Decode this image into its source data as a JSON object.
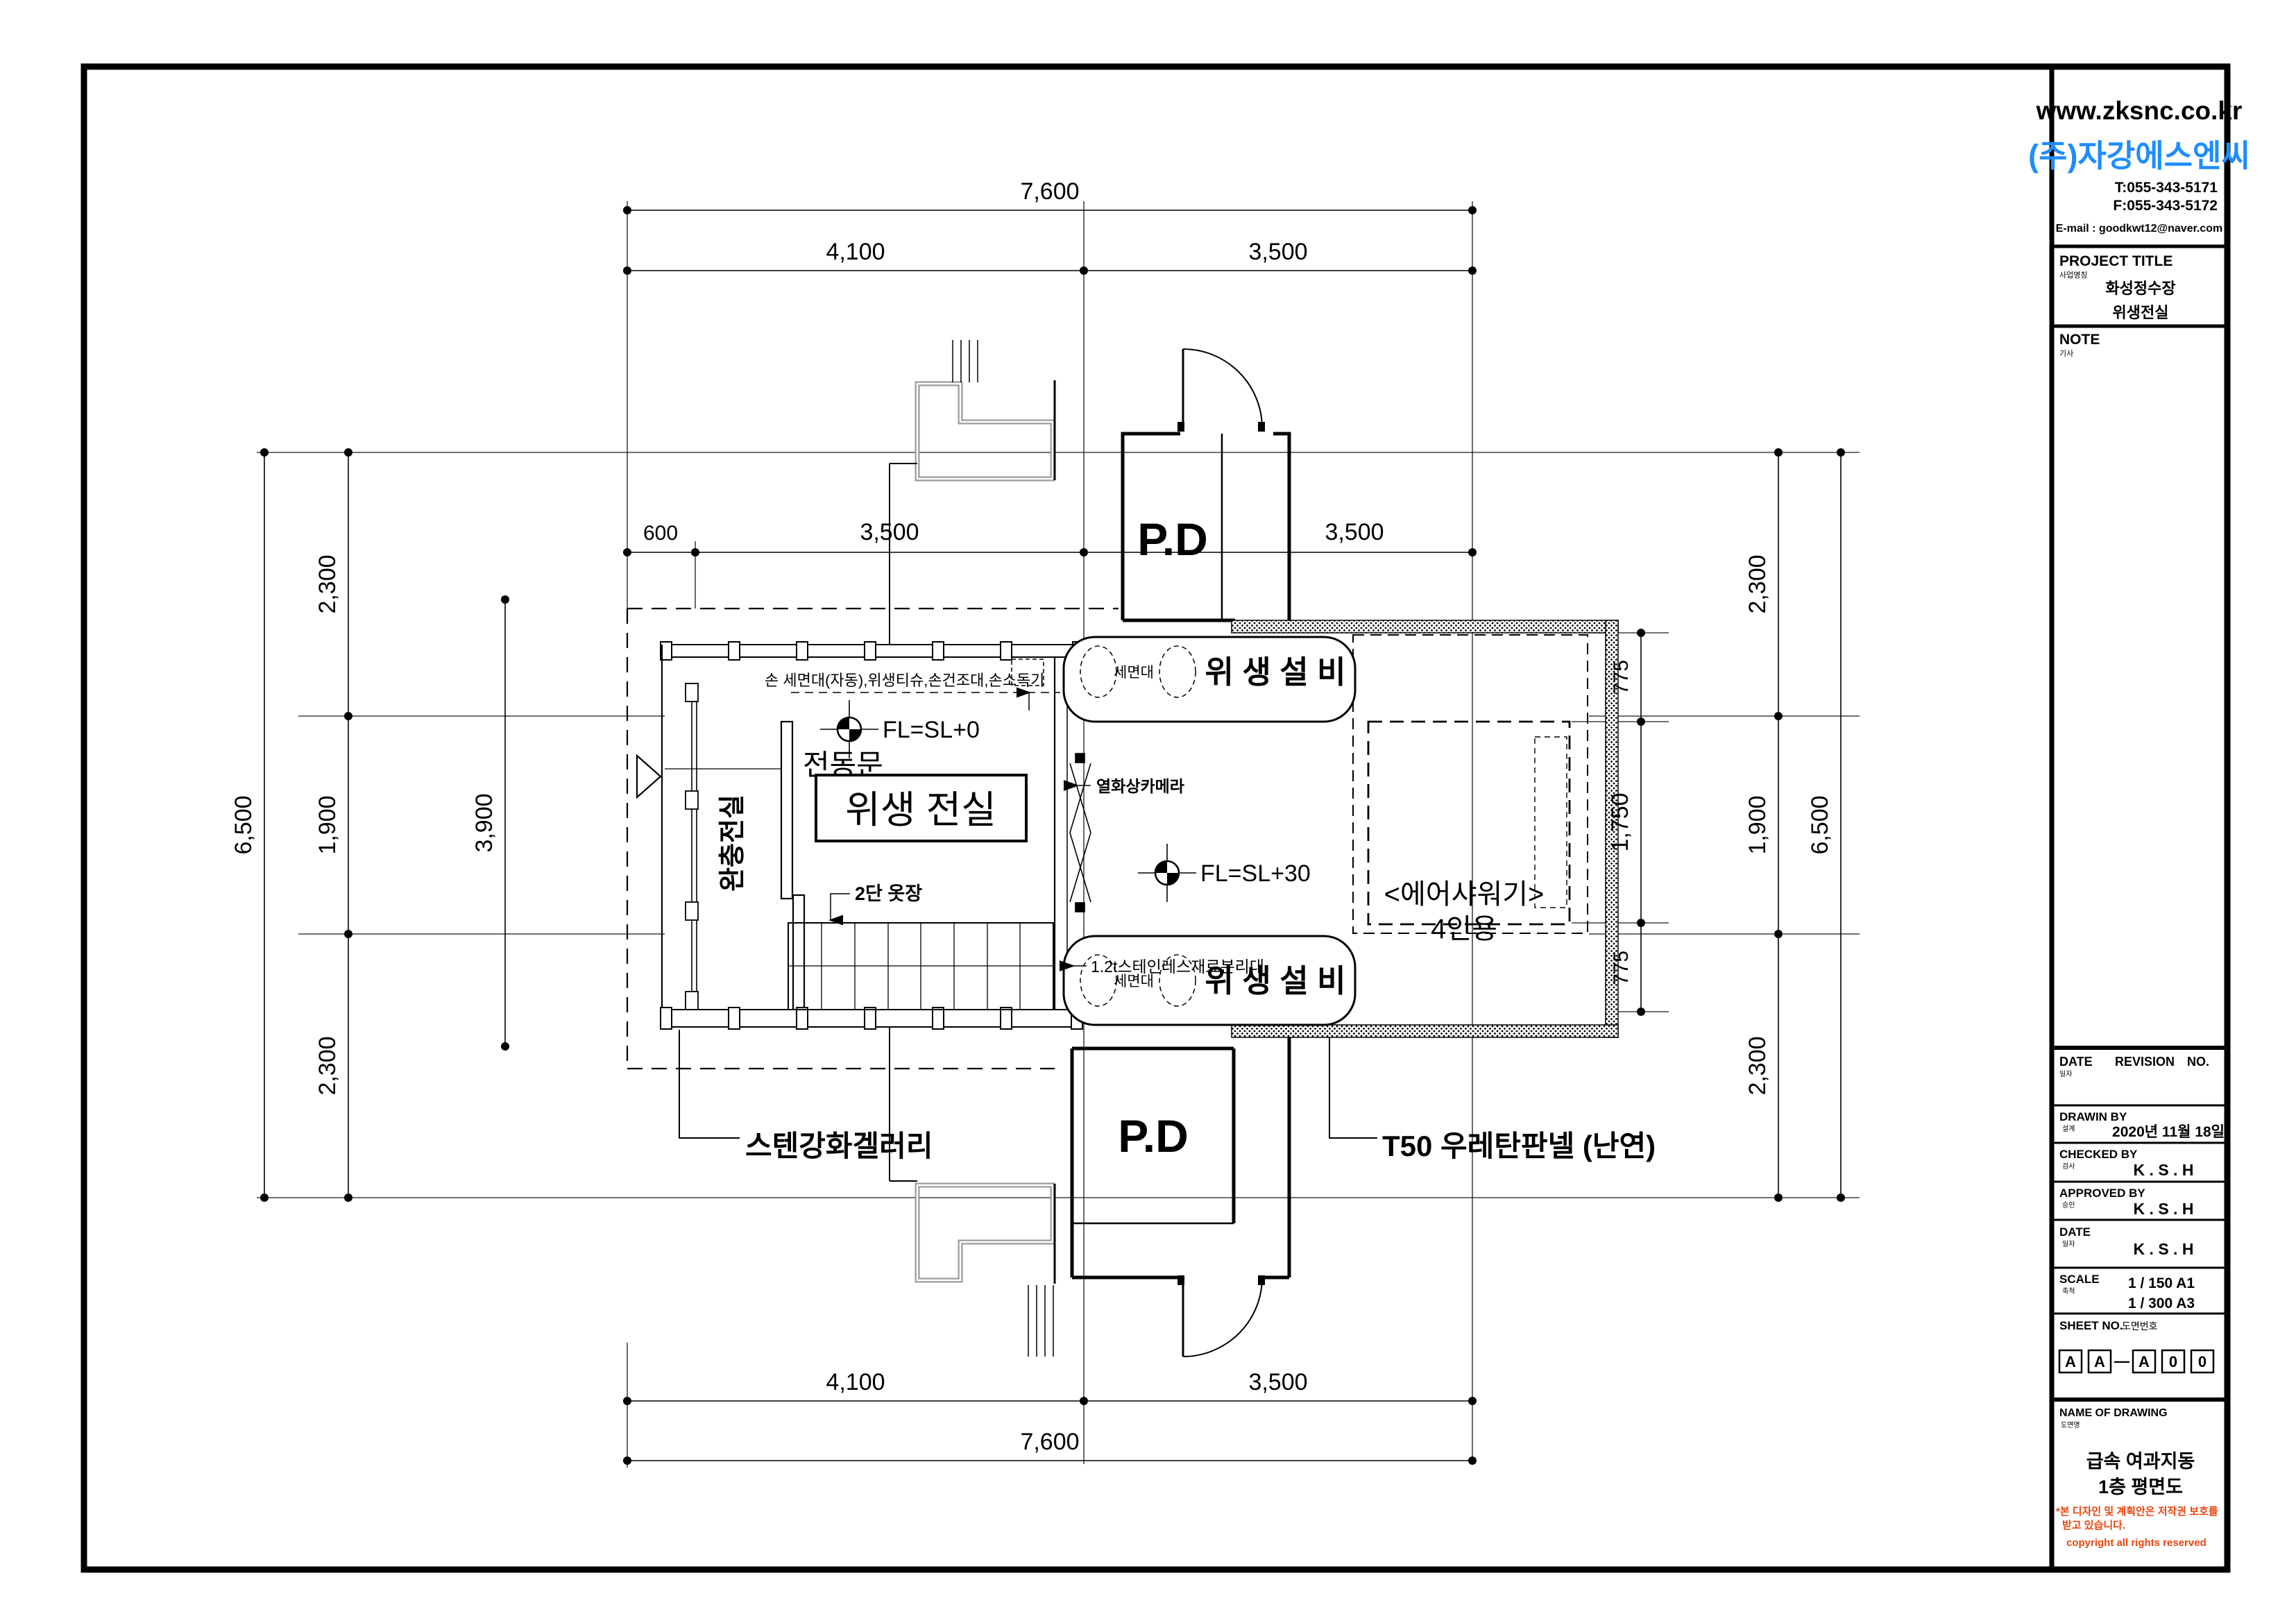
{
  "title_block": {
    "website": "www.zksnc.co.kr",
    "company": "(주)자강에스엔씨",
    "tel": "T:055-343-5171",
    "fax": "F:055-343-5172",
    "email": "E-mail : goodkwt12@naver.com",
    "project_title_label": "PROJECT TITLE",
    "project_title_sub": "사업명칭",
    "project_name_line1": "화성정수장",
    "project_name_line2": "위생전실",
    "note_label": "NOTE",
    "note_sub": "기사",
    "revision_header": {
      "date_label": "DATE",
      "date_sub": "일자",
      "revision_label": "REVISION",
      "no_label": "NO."
    },
    "drawn_by": {
      "label": "DRAWIN BY",
      "sub": "설계",
      "value": "2020년 11월 18일"
    },
    "checked_by": {
      "label": "CHECKED BY",
      "sub": "검사",
      "value": "K . S . H"
    },
    "approved_by": {
      "label": "APPROVED BY",
      "sub": "승인",
      "value": "K . S . H"
    },
    "date_row": {
      "label": "DATE",
      "sub": "일자",
      "value": "K . S . H"
    },
    "scale": {
      "label": "SCALE",
      "sub": "축척",
      "value_a1": "1 /   150    A1",
      "value_a3": "1 /   300    A3"
    },
    "sheet_no": {
      "label": "SHEET NO.",
      "sub": "도면번호",
      "boxes": [
        "A",
        "A",
        "A",
        "0",
        "0"
      ],
      "separator": "—"
    },
    "name_of_drawing": {
      "label": "NAME OF DRAWING",
      "sub": "도면명",
      "line1": "급속 여과지동",
      "line2": "1층 평면도"
    },
    "copyright": {
      "line1": "*본 디자인 및 계획안은  저작권 보호를",
      "line2": "받고 있습니다.",
      "line3": "copyright all rights reserved"
    }
  },
  "plan": {
    "rooms": {
      "main_room": "위생 전실",
      "buffer_room": "완충전실",
      "pd": "P.D"
    },
    "annotations": {
      "equip_note": "손 세면대(자동),위생티슈,손건조대,손소독기",
      "electric_door": "전동문",
      "level_main": "FL=SL+0",
      "level_corridor": "FL=SL+30",
      "thermal_camera": "열화상카메라",
      "steel_table": "1.2t스테인레스재료분리대",
      "washstand": "세면대",
      "sanitary_equipment": "위 생 설 비",
      "air_shower_line1": "<에어샤워기>",
      "air_shower_line2": "4인용",
      "wardrobe": "2단 옷장",
      "gallery": "스텐강화겔러리",
      "urethane_panel": "T50 우레탄판넬 (난연)"
    },
    "dims": {
      "top_total": "7,600",
      "top_left": "4,100",
      "top_right": "3,500",
      "row2_a": "600",
      "row2_b": "3,500",
      "row2_c": "3,500",
      "bottom_left": "4,100",
      "bottom_right": "3,500",
      "bottom_total": "7,600",
      "left_overall": "6,500",
      "left_a": "2,300",
      "left_b": "1,900",
      "left_c": "2,300",
      "right_overall": "6,500",
      "right_a": "2,300",
      "right_b": "1,900",
      "right_c": "2,300",
      "inner_height": "3,900",
      "shower_top": "775",
      "shower_mid": "1,750",
      "shower_bottom": "775"
    }
  },
  "colors": {
    "line": "#000000",
    "gray_wall": "#9b9b9b",
    "company_blue": "#1e8dff",
    "copyright_red": "#e8440c",
    "paper": "#ffffff"
  }
}
